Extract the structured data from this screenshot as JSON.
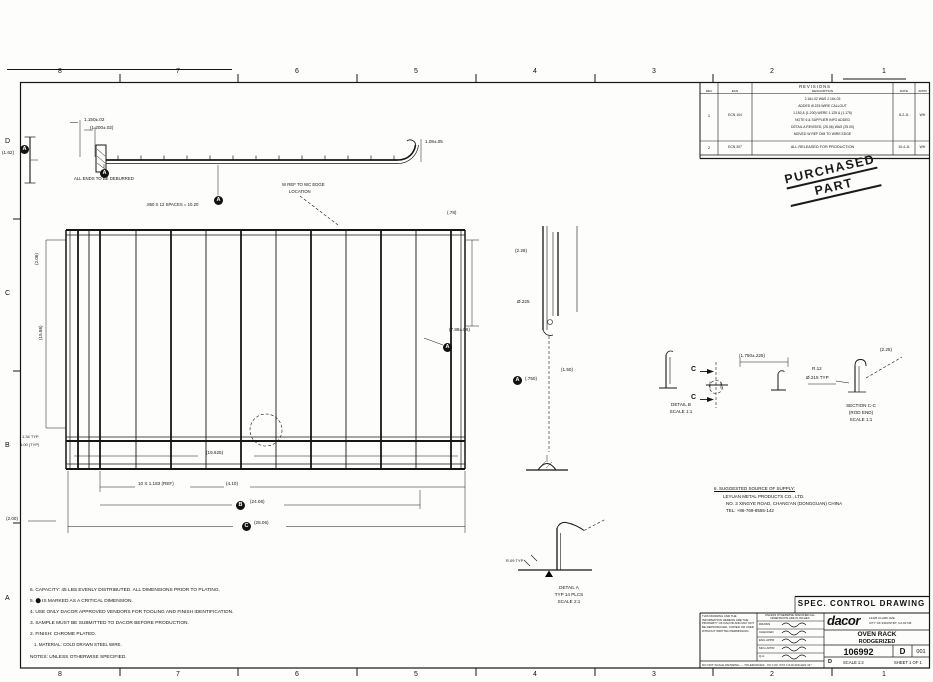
{
  "sheet": {
    "zones_top": [
      "8",
      "7",
      "6",
      "5",
      "4",
      "3",
      "2",
      "1"
    ],
    "zones_bottom": [
      "8",
      "7",
      "6",
      "5",
      "4",
      "3",
      "2",
      "1"
    ],
    "zones_left": [
      "D",
      "C",
      "B",
      "A"
    ]
  },
  "stamp": {
    "line1": "PURCHASED",
    "line2": "PART"
  },
  "revision_table": {
    "title": "REVISIONS",
    "headers": {
      "rev": "REV",
      "ecn": "ECN",
      "desc": "DESCRIPTION",
      "date": "DATE",
      "appr": "APPR"
    },
    "row1": {
      "rev": "1",
      "ecn": "ECN 104",
      "date": "8-2-11",
      "appr": "WH",
      "lines": [
        "2.16±.02 WAS 2.16±.03",
        "ADDED Ø.225 WIRE CALLOUT",
        "1.150 & (1.200) WERE 1.125 & (1.175)",
        "NOTE 6 & SUPPLIER INFO ADDED",
        "DETAIL A REVISED; (25.06) WAS (25.00)",
        "MOVED W REF DIM TO WIRE EDGE"
      ]
    },
    "row2": {
      "rev": "2",
      "ecn": "ECN 307",
      "desc": "ALL RELEASED FOR PRODUCTION",
      "date": "10-4-11",
      "appr": "WH"
    }
  },
  "notes": {
    "lines": [
      "6. CAPACITY: 45 LBS EVENLY DISTRIBUTED. ALL DIMENSIONS PRIOR TO PLATING.",
      "5. ⬤ IS MARKED AS A CRITICAL DIMENSION.",
      "4. USE ONLY DACOR APPROVED VENDORS FOR TOOLING AND FINISH IDENTIFICATION.",
      "3. SAMPLE MUST BE SUBMITTED TO DACOR BEFORE PRODUCTION.",
      "2. FINISH: CHROME PLATED.",
      "1. MATERIAL: COLD DRAWN STEEL WIRE.",
      "NOTES: UNLESS OTHERWISE SPECIFIED."
    ]
  },
  "supplier_note": {
    "lines": [
      "6. SUGGESTED SOURCE OF SUPPLY:",
      "LEYUAN METAL PRODUCTS CO., LTD.",
      "NO. 3 XINGYE ROAD, CHANG'AN (DONGGUAN) CHINA",
      "TEL: +86-769-8555-142"
    ]
  },
  "drawing": {
    "labels": [
      "1.150±.02",
      "(1.200±.02)",
      "(1.62)",
      "1.08±.05",
      "ALL ENDS TO BE DEBURRED",
      ".850 X 12 SPACES = 10.20",
      "W REF TO WC EDGE",
      "LOCATION",
      "(.78)",
      "(19.625)",
      "10 X 1.183 (REF)",
      "(4.10)",
      "(24.06)",
      "(25.06)",
      "1.34 TYP",
      "4.00 (TYP)",
      "(2.00)",
      "(15.86)",
      "(2.06)",
      "(7.88±.06)",
      "(2.28)",
      "Ø.225",
      "(1.50)",
      "(.750)",
      "(1.750±.225)",
      "SECTION C-C",
      "(ROD END)",
      "SCALE 1:1",
      "DETAIL B",
      "SCALE 1:1",
      "(2.25)",
      "R.12",
      "Ø.215 TYP",
      "DETAIL A",
      "TYP 14 PLCS",
      "SCALE 2:1",
      "R.09 TYP",
      "C",
      "C"
    ],
    "balloons": [
      {
        "t": "A"
      },
      {
        "t": "A"
      },
      {
        "t": "A"
      },
      {
        "t": "A"
      },
      {
        "t": "A"
      },
      {
        "t": "B"
      },
      {
        "t": "C"
      }
    ]
  },
  "title_block": {
    "spec_title": "SPEC. CONTROL DRAWING",
    "proprietary": "This drawing and the information hereon are the property of Dacor and may not be reproduced, copied or used without written permission.",
    "tolerance_note": "Unless otherwise specified all dimensions are in inches",
    "bottom_note": "DO NOT SCALE DRAWING — TOLERANCES: .XX ±.03  .XXX ±.010  ANGLES ±1°",
    "sign_labels": [
      "DRAWN",
      "CHECKED",
      "ENG APPR",
      "MFG APPR",
      "Q.A."
    ],
    "logo": "dacor",
    "address1": "14425 CLARK AVE.",
    "address2": "CITY OF INDUSTRY, CA 91745",
    "title_line1": "OVEN RACK",
    "title_line2": "RODGERIZED",
    "drawing_number": "106992",
    "size": "D",
    "rev": "001",
    "size2": "D",
    "scale": "SCALE 1:2",
    "sheet": "SHEET 1 OF 1"
  }
}
